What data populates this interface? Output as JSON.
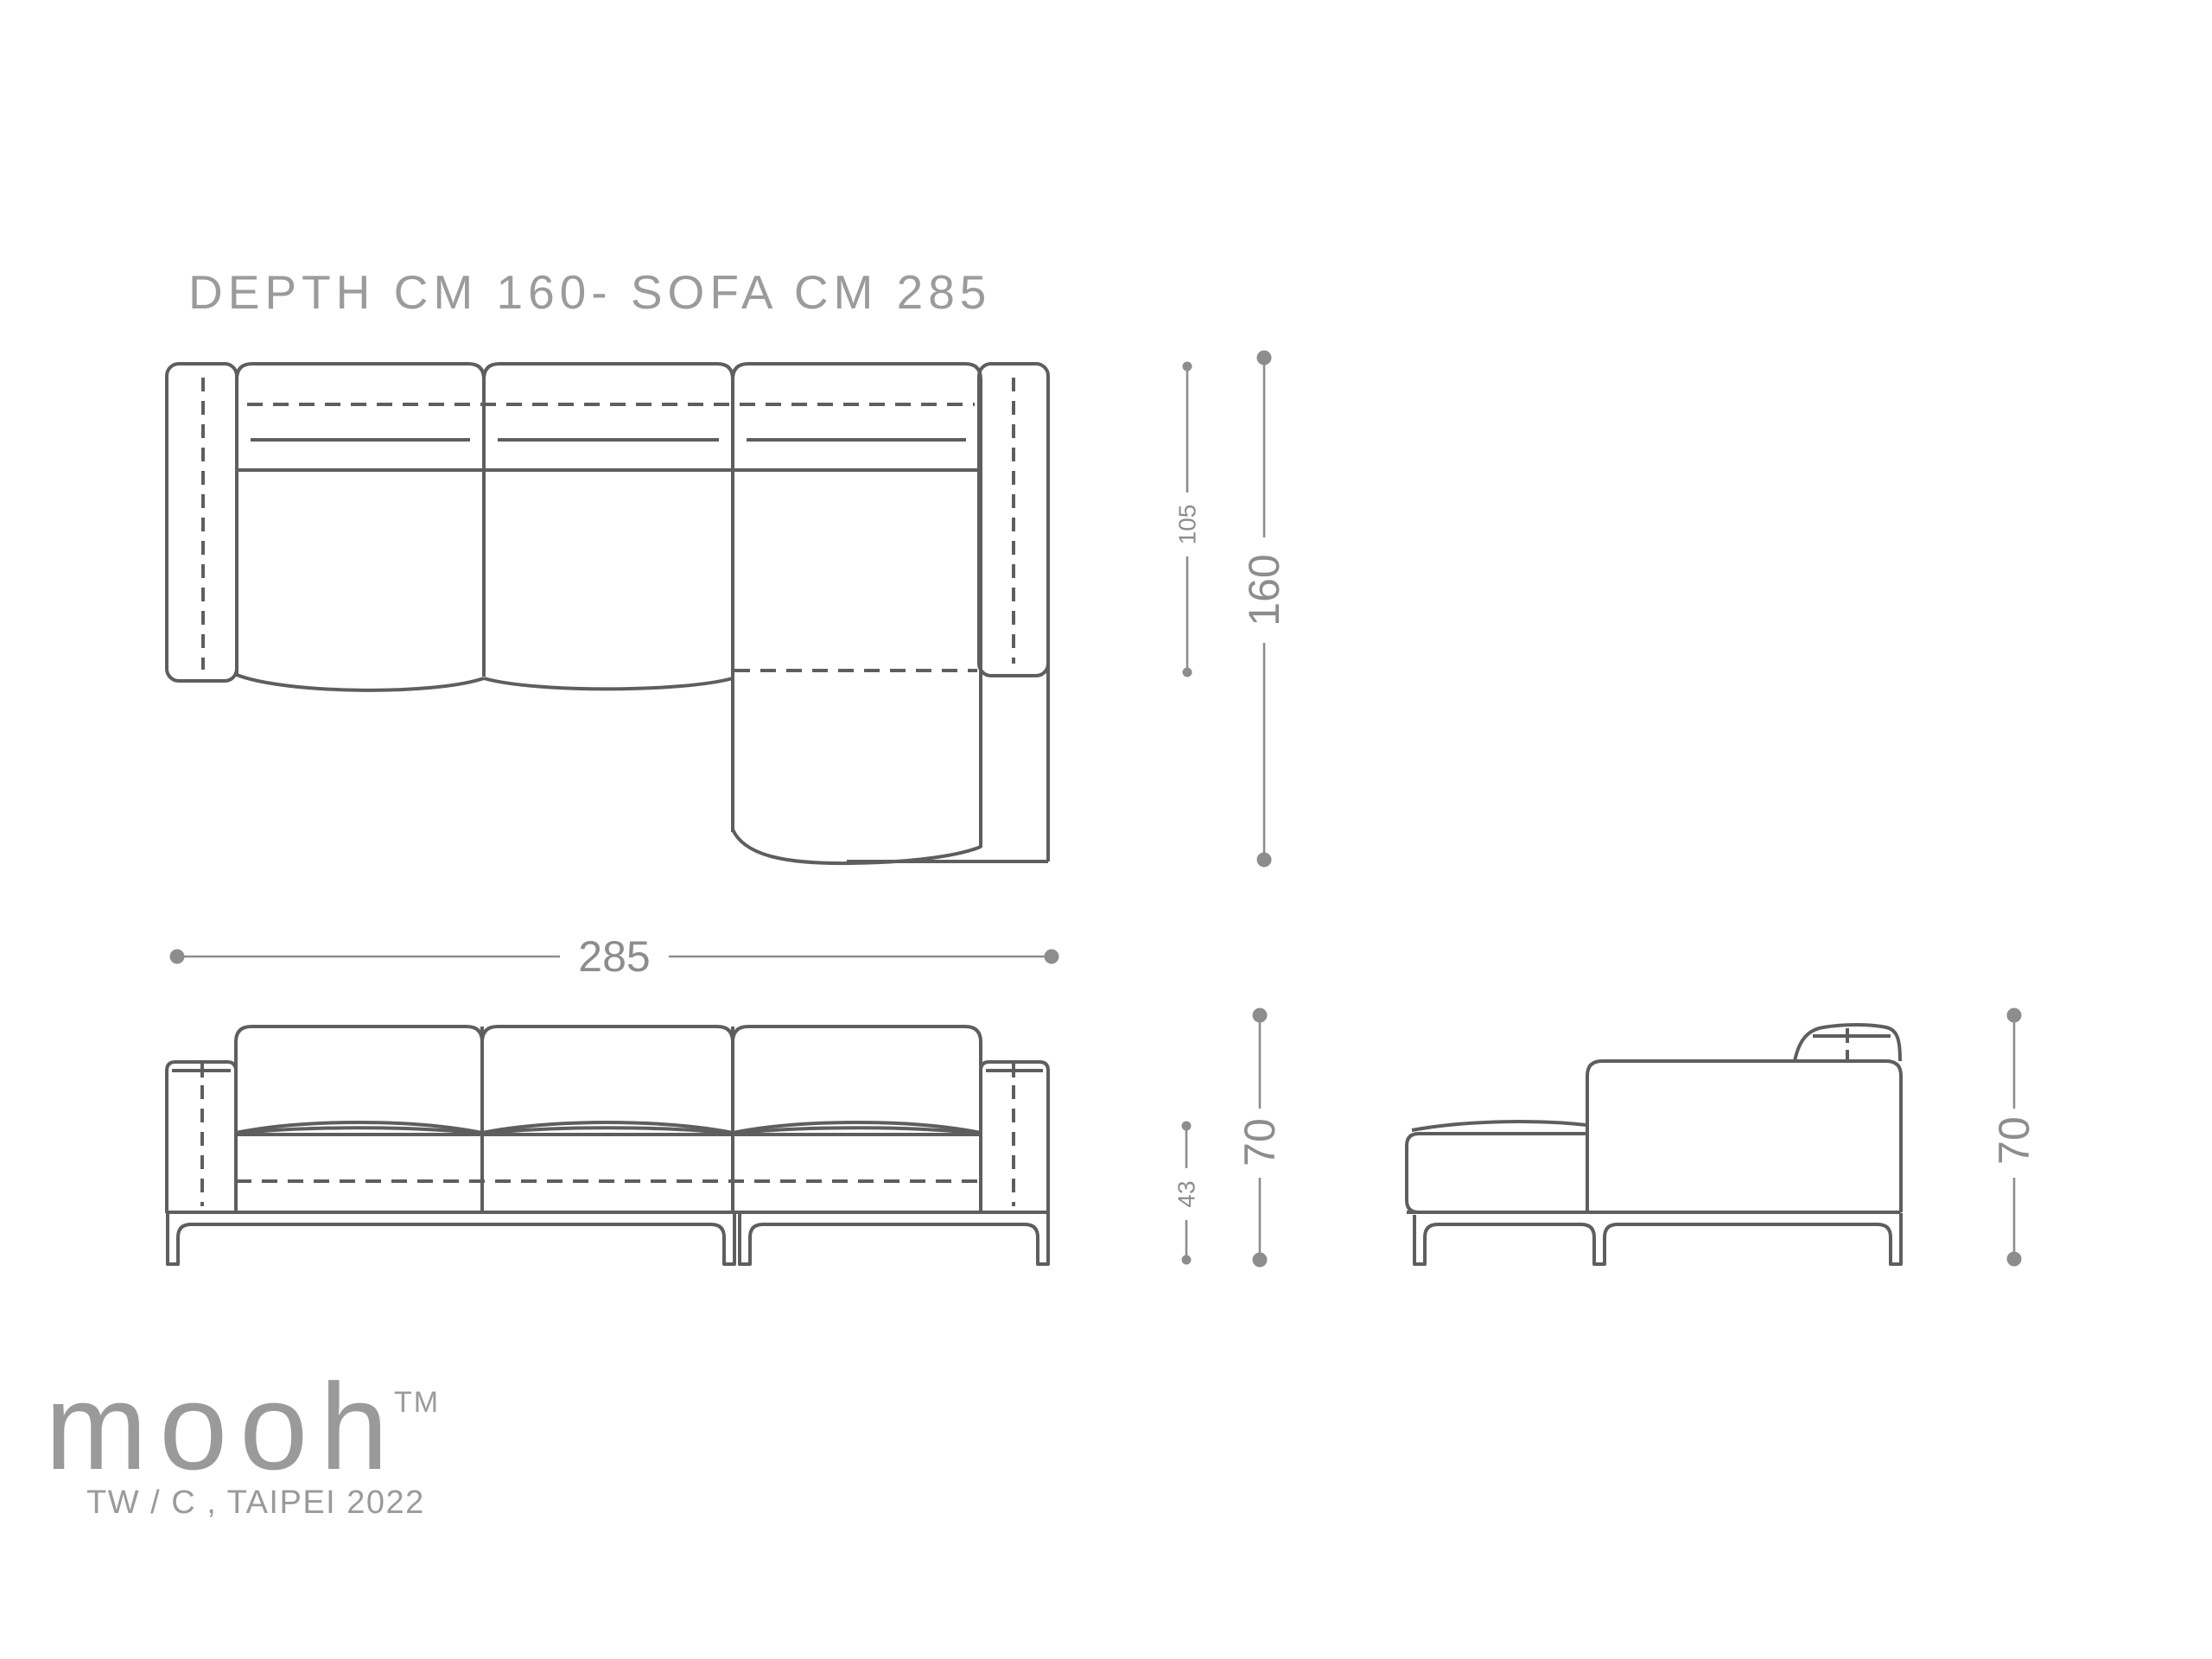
{
  "title": "DEPTH CM 160- SOFA CM 285",
  "colors": {
    "background": "#ffffff",
    "drawing": "#5e5e5e",
    "dimension": "#8d8d8d",
    "title": "#9b9b9b",
    "logo": "#9a9a9a"
  },
  "dimensions": {
    "plan_seat_depth": "105",
    "plan_total_depth": "160",
    "front_total_width": "285",
    "front_seat_height": "43",
    "front_total_height": "70",
    "side_total_height": "70"
  },
  "logo": {
    "wordmark": "mooh",
    "trademark": "TM",
    "tagline": "TW / C , TAIPEI 2022"
  }
}
